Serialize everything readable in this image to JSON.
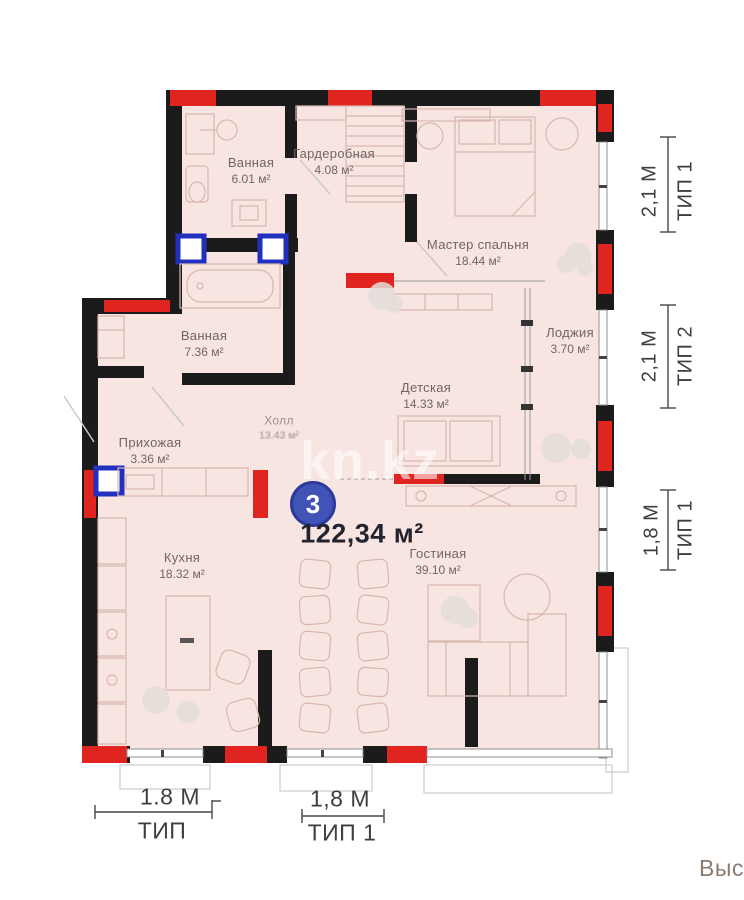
{
  "plan": {
    "unit_number": "3",
    "total_area": "122,34 м²",
    "watermark": "kn.kz",
    "corner_label": "Выс",
    "rooms": [
      {
        "name": "Ванная",
        "area": "6.01 м²"
      },
      {
        "name": "Гардеробная",
        "area": "4.08 м²"
      },
      {
        "name": "Мастер спальня",
        "area": "18.44 м²"
      },
      {
        "name": "Ванная",
        "area": "7.36 м²"
      },
      {
        "name": "Лоджия",
        "area": "3.70 м²"
      },
      {
        "name": "Детская",
        "area": "14.33 м²"
      },
      {
        "name": "Прихожая",
        "area": "3.36 м²"
      },
      {
        "name": "Холл",
        "area": "13.43 м²"
      },
      {
        "name": "Кухня",
        "area": "18.32 м²"
      },
      {
        "name": "Гостиная",
        "area": "39.10 м²"
      }
    ],
    "dimensions": {
      "right": [
        {
          "size": "2,1 М",
          "type": "ТИП 1"
        },
        {
          "size": "2,1 М",
          "type": "ТИП 2"
        },
        {
          "size": "1,8 М",
          "type": "ТИП 1"
        }
      ],
      "bottom": [
        {
          "size": "1.8 М",
          "type": "ТИП"
        },
        {
          "size": "1,8 М",
          "type": "ТИП 1"
        }
      ]
    }
  },
  "colors": {
    "floor_fill": "#f8e4e0",
    "wall": "#1b1b1b",
    "accent_red": "#e02420",
    "vent_blue": "#2230bf",
    "badge_blue": "#4153b6",
    "dimension_text": "#3e3e3e",
    "room_text": "#6f6760",
    "corner_text": "#8d7b70"
  }
}
